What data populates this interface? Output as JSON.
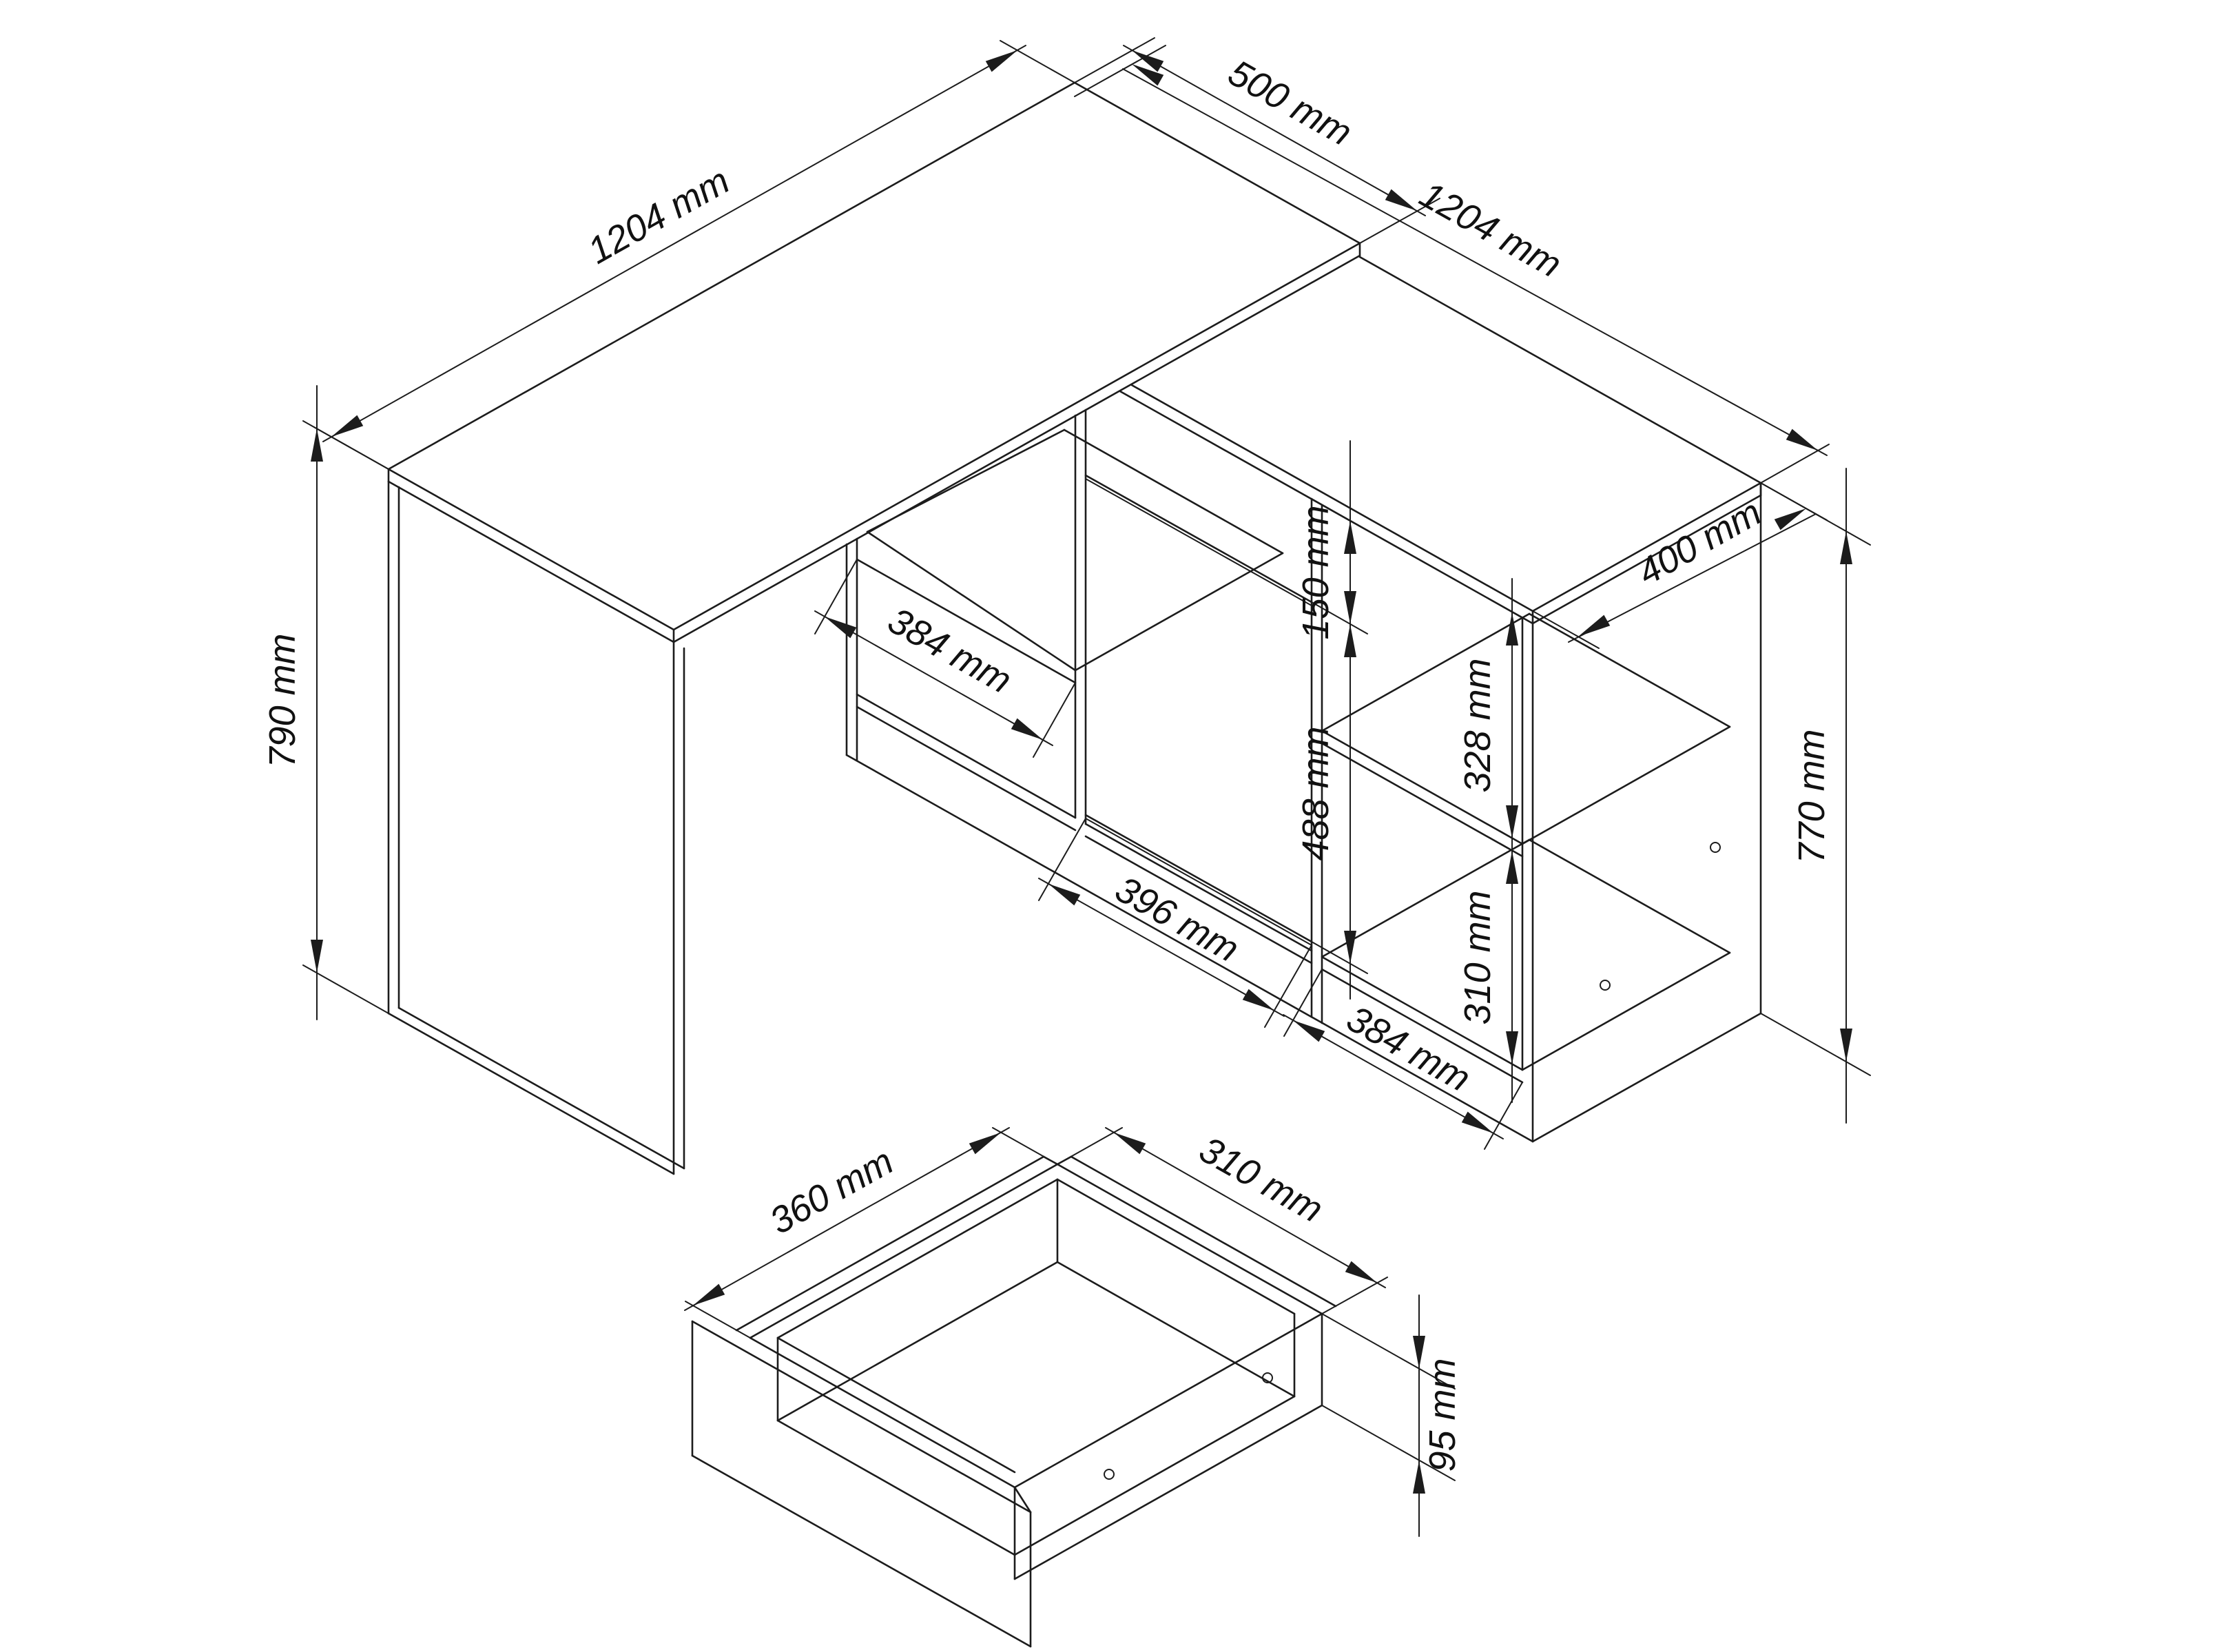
{
  "drawing": {
    "type": "furniture-technical-drawing",
    "subject": "L-shaped corner desk with sideboard and drawer detail",
    "unit": "mm",
    "line_color": "#1c1c1c",
    "background": "#ffffff"
  },
  "dimensions": {
    "desk_top_length": "1204 mm",
    "desk_top_depth": "500 mm",
    "desk_height": "790 mm",
    "cabinet_length": "1204 mm",
    "cabinet_depth": "400 mm",
    "cabinet_height": "770 mm",
    "desk_shelf_width": "384 mm",
    "door_width": "396 mm",
    "drawer_front_height": "150 mm",
    "door_height": "488 mm",
    "upper_compartment_height": "328 mm",
    "lower_compartment_height": "310 mm",
    "compartment_width": "384 mm",
    "drawer_depth": "360 mm",
    "drawer_width": "310 mm",
    "drawer_side_height": "95 mm"
  }
}
